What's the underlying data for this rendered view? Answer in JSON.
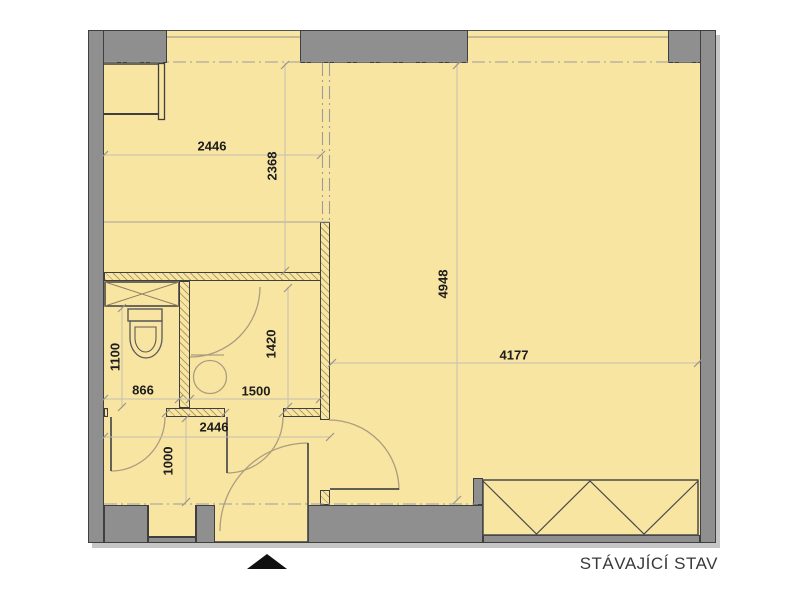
{
  "caption": "STÁVAJÍCÍ STAV",
  "dimensions_mm": {
    "kitchen_width": "2446",
    "kitchen_depth": "2368",
    "living_depth": "4948",
    "living_width": "4177",
    "wc_depth": "1100",
    "wc_width": "866",
    "bathroom_depth": "1420",
    "bathroom_width": "1500",
    "hall_width": "2446",
    "hall_depth": "1000"
  },
  "colors": {
    "floor": "#f9e5a2",
    "exterior_wall": "#8f8f8f",
    "wall_outline": "#3f3f3f",
    "door_arc": "#ab9d7d",
    "dimension_line": "#c2bfb4",
    "dimension_text": "#1c1c1c",
    "caption_text": "#3a3a3a",
    "centerline": "#9c9c9c",
    "background": "#ffffff",
    "shadow": "#c6c6c6"
  },
  "symbols": {
    "entrance_arrow": "black up-triangle at entry door",
    "wardrobe": "zigzag box along bottom wall of living room",
    "shaft": "crossed rectangle next to wc",
    "toilet": "bowl with cistern in wc",
    "washbasin": "circle in bathroom",
    "windows": "two openings in top exterior wall",
    "centerlines": "dash-dot lines along wall axes"
  }
}
